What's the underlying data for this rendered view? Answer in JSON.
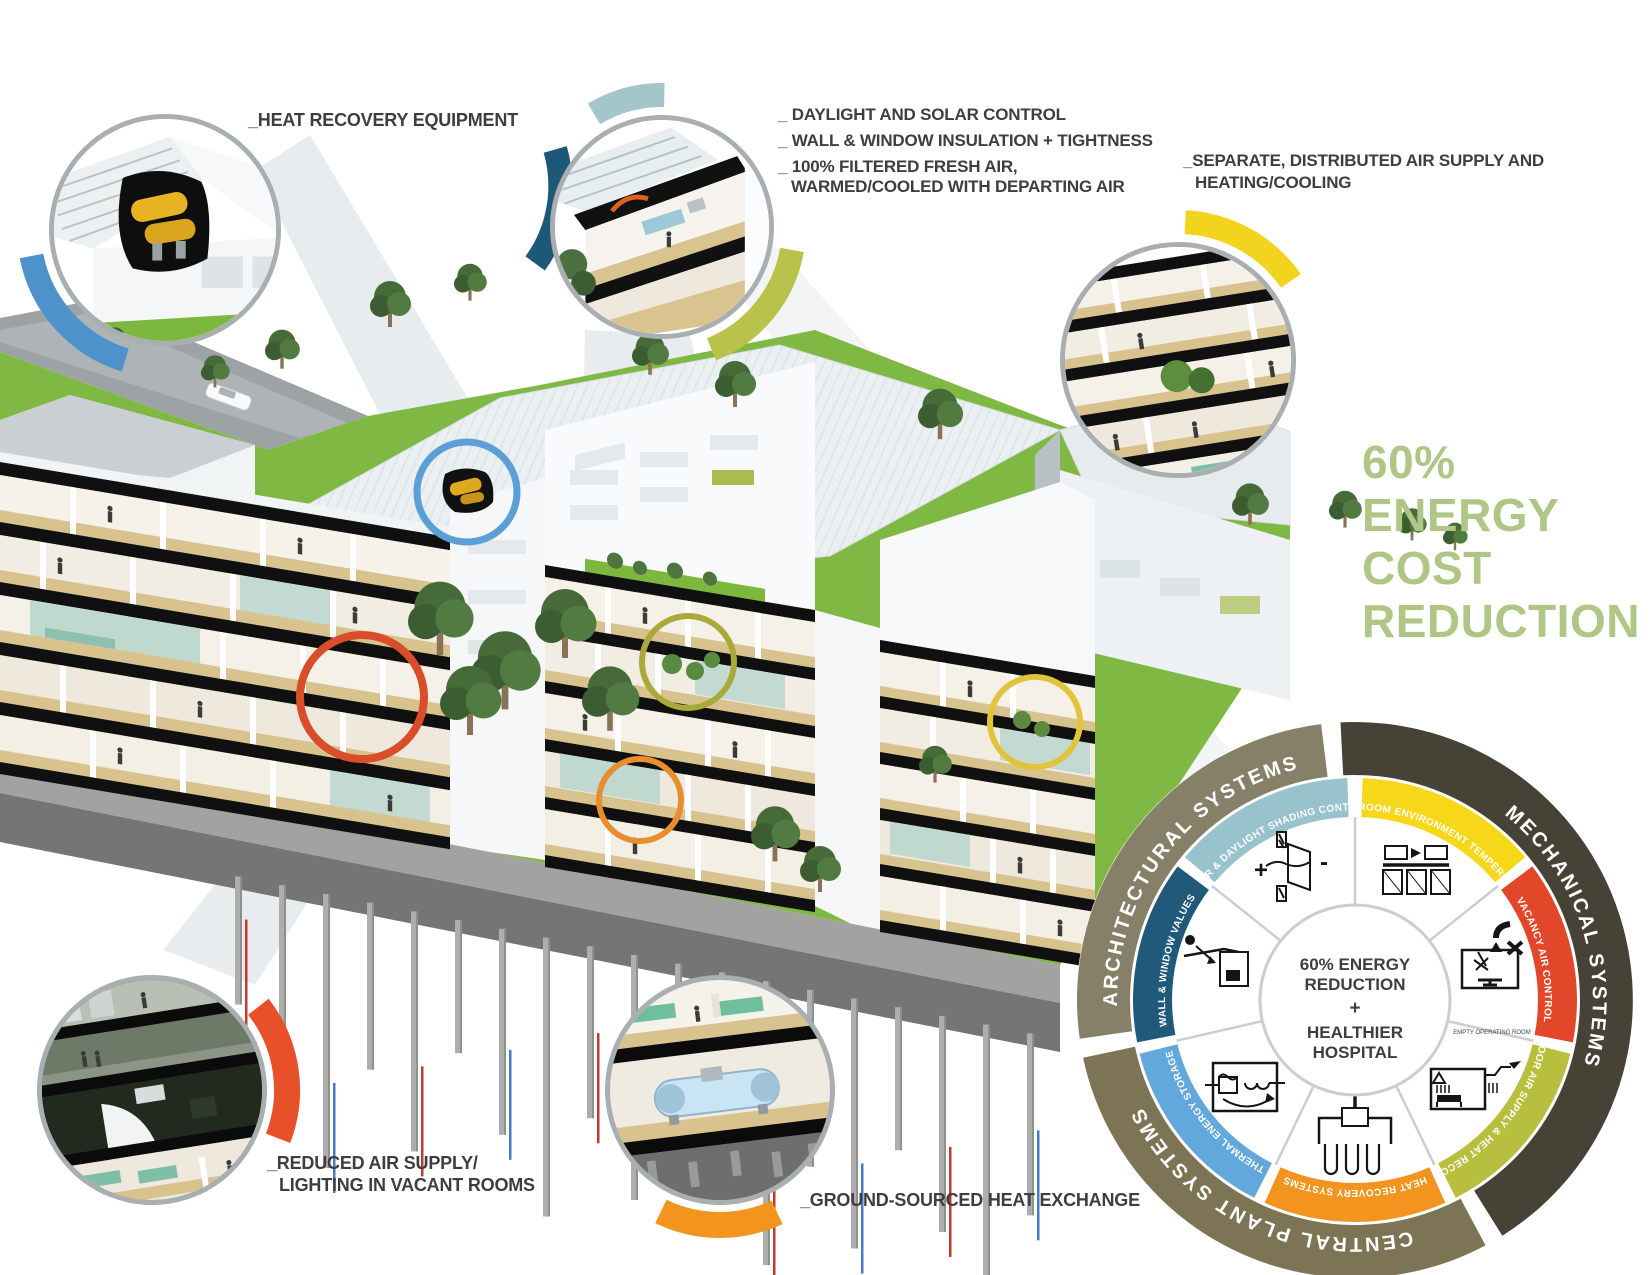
{
  "headline": {
    "lines": [
      "60%",
      "ENERGY",
      "COST",
      "REDUCTION"
    ],
    "color": "#AFC687"
  },
  "callouts": {
    "heat_recovery": {
      "label": "_HEAT RECOVERY EQUIPMENT",
      "arc_color": "#4E92CC"
    },
    "daylight": {
      "lines": [
        "_ DAYLIGHT AND SOLAR CONTROL",
        "_ WALL & WINDOW INSULATION + TIGHTNESS",
        "_ 100% FILTERED FRESH AIR,",
        "WARMED/COOLED WITH DEPARTING AIR"
      ],
      "arc_teal": "#A3C6CA",
      "arc_navy": "#1E5877",
      "arc_olive": "#B9C24B"
    },
    "separate_air": {
      "lines": [
        "_SEPARATE, DISTRIBUTED AIR SUPPLY AND",
        "HEATING/COOLING"
      ],
      "arc_color": "#F2D41E"
    },
    "reduced_air": {
      "lines": [
        "_REDUCED AIR SUPPLY/",
        "LIGHTING IN VACANT ROOMS"
      ],
      "arc_color": "#E8502A"
    },
    "ground_heat": {
      "label": "_GROUND-SOURCED HEAT EXCHANGE",
      "arc_color": "#F3941E"
    }
  },
  "wheel": {
    "center": {
      "lines": [
        "60% ENERGY",
        "REDUCTION",
        "+",
        "HEALTHIER",
        "HOSPITAL"
      ]
    },
    "outer_segments": [
      {
        "label": "MECHANICAL SYSTEMS",
        "color": "#474236"
      },
      {
        "label": "CENTRAL PLANT SYSTEMS",
        "color": "#7D7455"
      },
      {
        "label": "ARCHITECTURAL SYSTEMS",
        "color": "#878068"
      }
    ],
    "inner_segments": [
      {
        "label": "IN-ROOM ENVIRONMENT TEMPERING",
        "color": "#F7D818"
      },
      {
        "label": "VACANCY AIR CONTROL",
        "color": "#E2472A"
      },
      {
        "label": "OUTDOOR AIR SUPPLY & HEAT RECOVERY",
        "color": "#B8BF3E"
      },
      {
        "label": "HEAT RECOVERY SYSTEMS",
        "color": "#F3941E"
      },
      {
        "label": "THERMAL ENERGY STORAGE",
        "color": "#62A8DC"
      },
      {
        "label": "WALL & WINDOW VALUES",
        "color": "#20597A"
      },
      {
        "label": "SOLAR & DAYLIGHT SHADING CONTROLS",
        "color": "#98C2CC"
      }
    ],
    "vacancy_caption": "EMPTY OPERATING ROOM"
  }
}
